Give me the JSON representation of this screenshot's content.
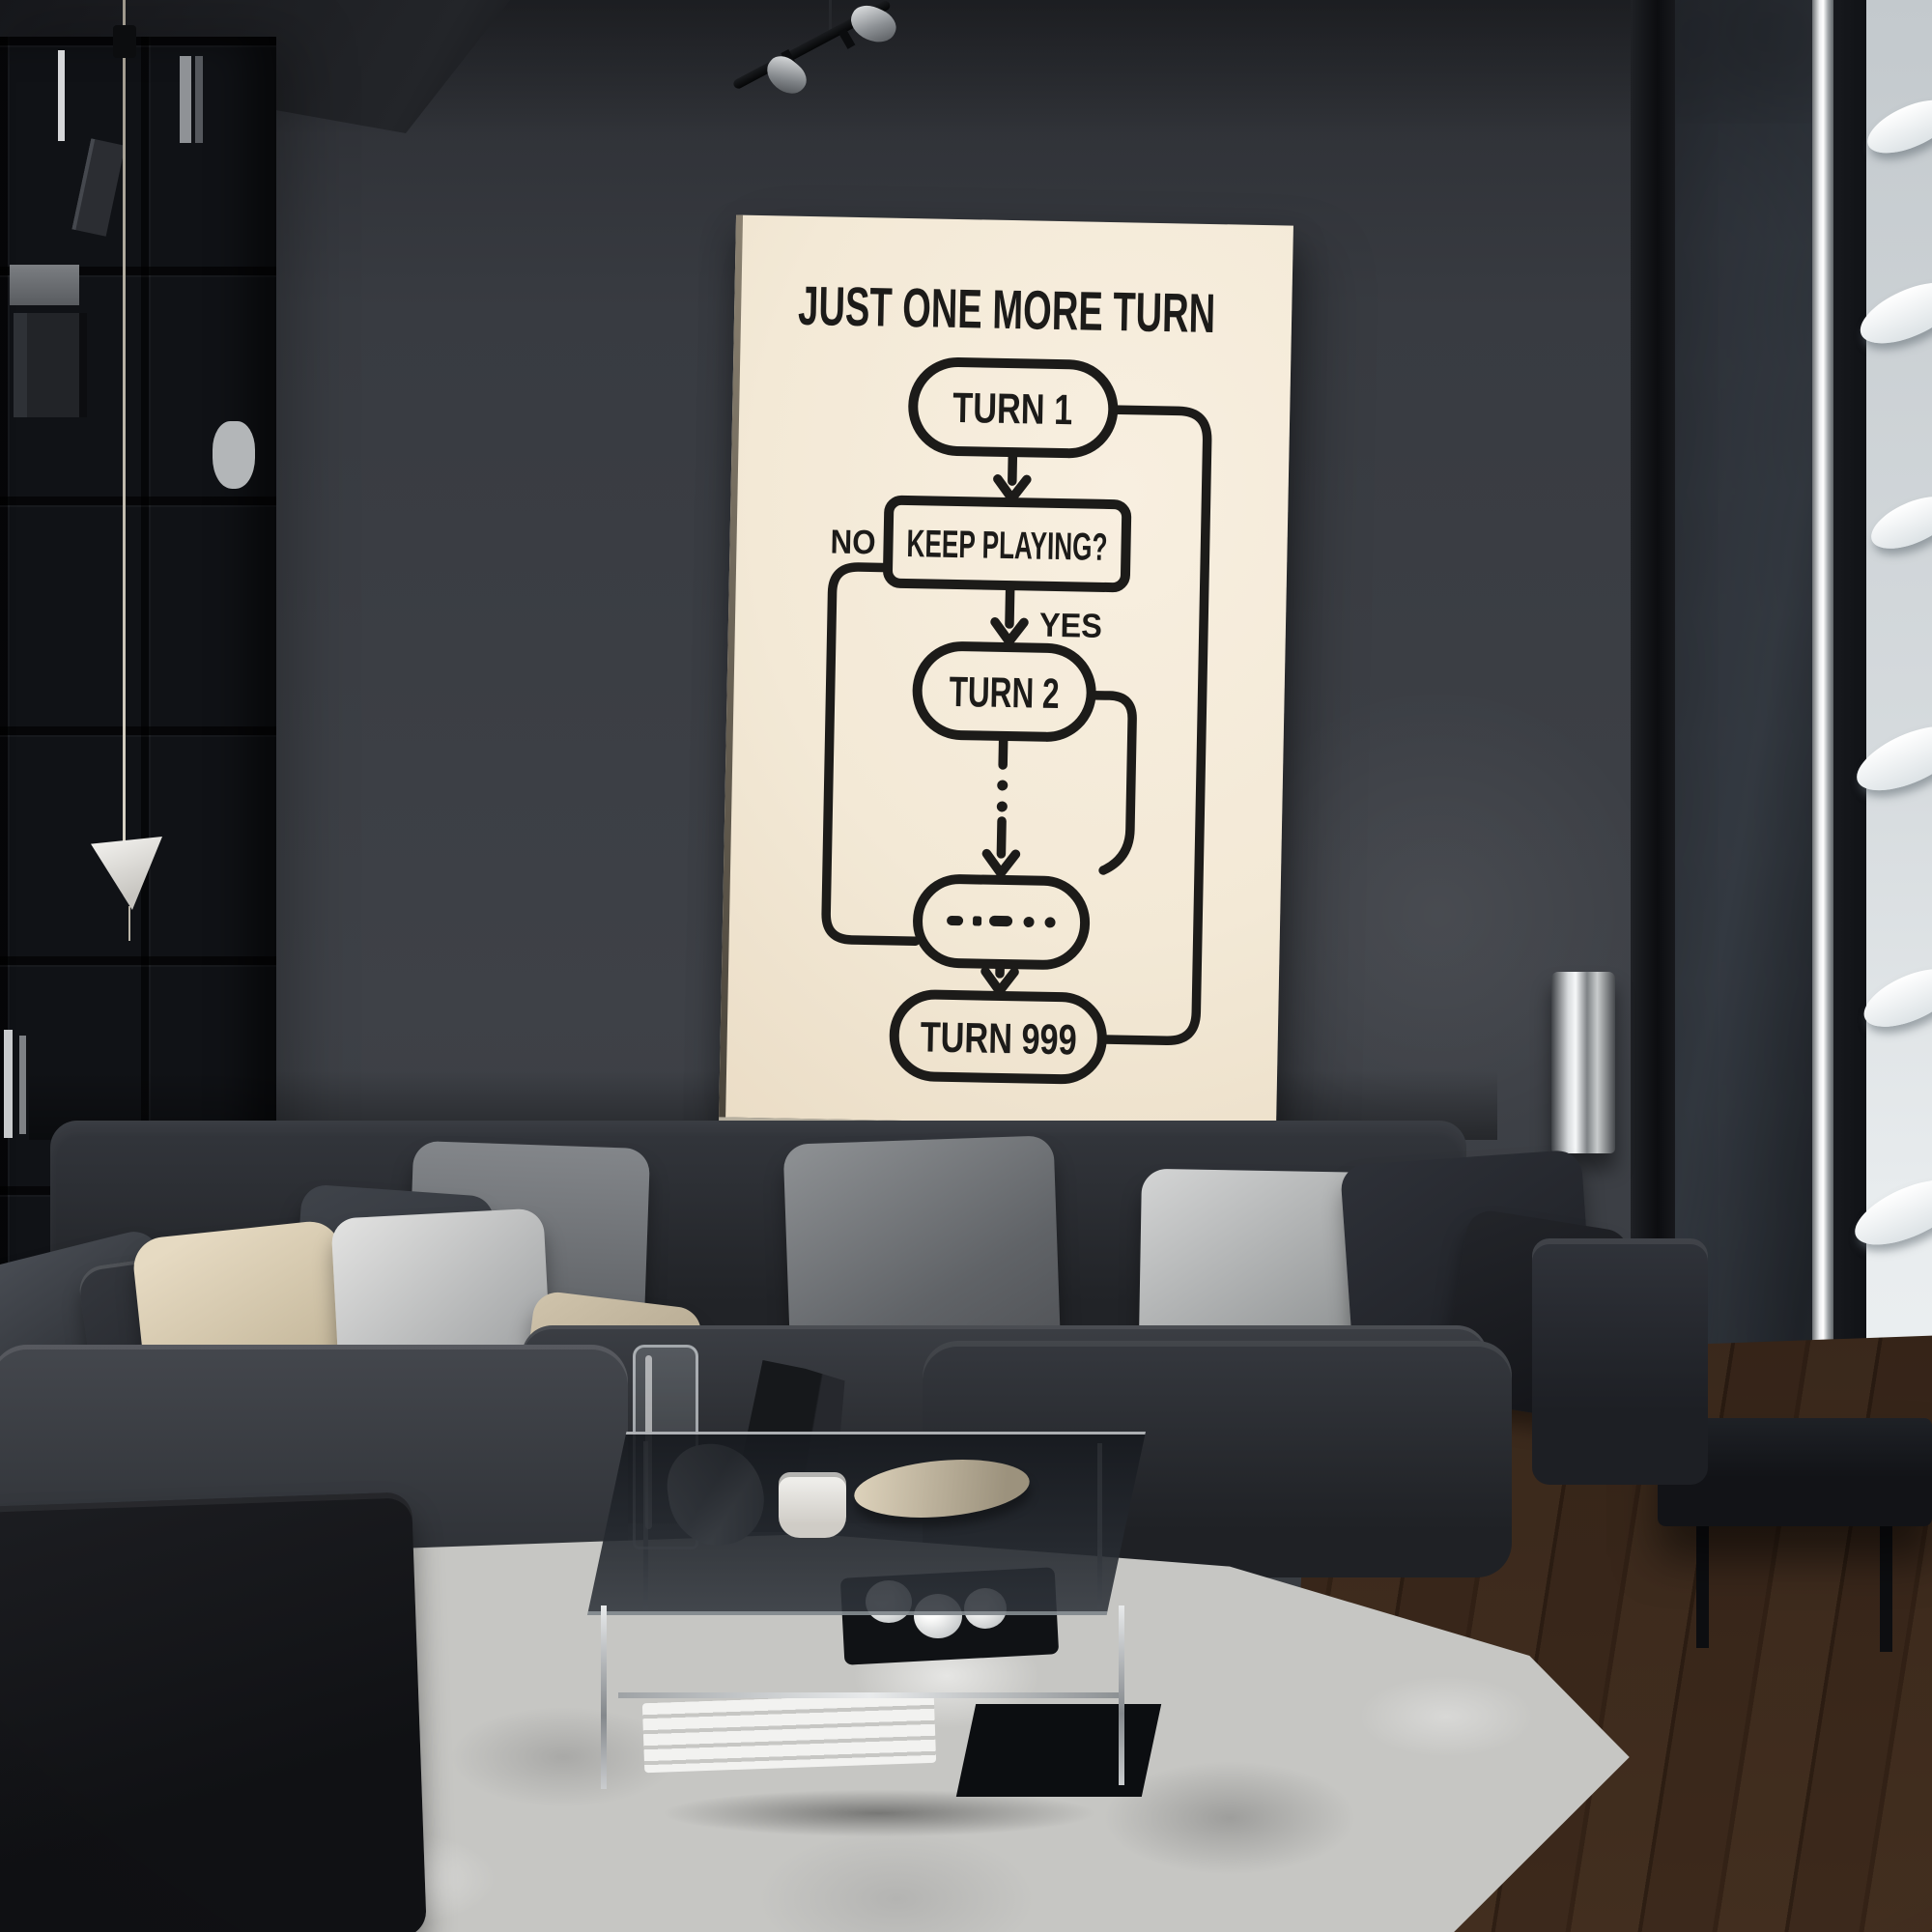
{
  "image_kind": "photo of a living room with a framed flowchart poster (wall-art mockup)",
  "flowchart": {
    "title": "JUST ONE MORE TURN",
    "paper_color": "#f4ead8",
    "ink_color": "#1c1b19",
    "nodes": [
      {
        "id": "turn-1",
        "shape": "stadium",
        "label": "TURN 1"
      },
      {
        "id": "keep-playing",
        "shape": "rounded-rect",
        "label": "KEEP PLAYING?"
      },
      {
        "id": "turn-2",
        "shape": "stadium",
        "label": "TURN 2"
      },
      {
        "id": "ellipsis",
        "shape": "stadium",
        "label": "– · – · ·"
      },
      {
        "id": "turn-999",
        "shape": "stadium",
        "label": "TURN 999"
      }
    ],
    "edges": [
      {
        "from": "turn-1",
        "to": "keep-playing",
        "style": "arrow"
      },
      {
        "from": "keep-playing",
        "to": "turn-2",
        "style": "arrow",
        "label": "YES"
      },
      {
        "from": "keep-playing",
        "to": "ellipsis",
        "style": "elbow-left",
        "label": "NO"
      },
      {
        "from": "turn-2",
        "to": "ellipsis",
        "style": "dotted-arrow"
      },
      {
        "from": "turn-2",
        "to": "open-hook-right",
        "style": "open-hook"
      },
      {
        "from": "ellipsis",
        "to": "turn-999",
        "style": "arrow"
      },
      {
        "from": "turn-999",
        "to": "turn-1",
        "style": "return-loop-right"
      }
    ]
  },
  "room": {
    "wall_color": "#3a3d43",
    "bookshelf_color": "#101216",
    "sofa_color": "#24262b",
    "pillow_colors": [
      "#2a2d32",
      "#c7ba9e",
      "#a9abac",
      "#606367",
      "#1b1d22"
    ],
    "rug_color": "#c6c6c3",
    "floor_color": "#75604e",
    "window_snow_color": "#edf1f2",
    "chrome_color": "#d8dcdf",
    "lamp_shade_color": "#f0efec"
  }
}
